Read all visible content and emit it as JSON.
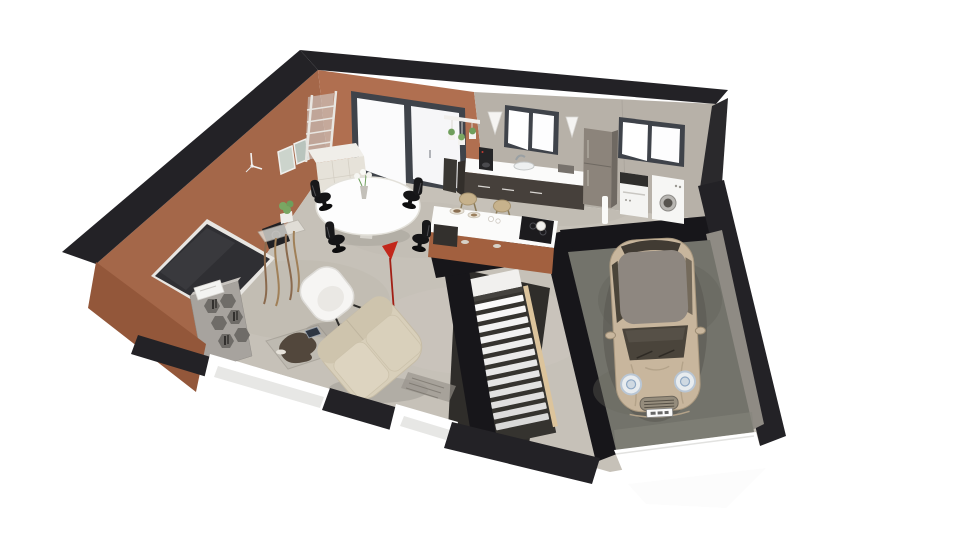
{
  "scene": {
    "type": "isometric-3d-floorplan-render",
    "description": "3D cutaway render of a single-storey house: open living/dining room with terracotta walls, kitchen with island, laundry corner, central staircase and attached garage with a parked compact car. Cut wall tops shown black, foundation shown white.",
    "rooms": [
      {
        "id": "living-room",
        "label": "Living room",
        "furniture": [
          "wall-mounted-tv",
          "speaker",
          "wall-clock",
          "picture-frames",
          "ladder-mirror",
          "honeycomb-shelf",
          "printer-box",
          "driftwood-console",
          "house-plant",
          "white-armchair",
          "cream-sofa",
          "glass-coffee-table",
          "tablet",
          "doormat"
        ]
      },
      {
        "id": "dining-area",
        "label": "Dining area",
        "furniture": [
          "white-sideboard",
          "oval-dining-table",
          "flower-vase",
          "black-designer-chair",
          "black-designer-chair",
          "black-designer-chair",
          "black-designer-chair",
          "red-floor-lamp"
        ]
      },
      {
        "id": "kitchen",
        "label": "Kitchen",
        "furniture": [
          "sliding-glass-door",
          "hanging-plant-shelf",
          "wall-sconce",
          "wall-sconce",
          "kitchen-window",
          "counter-with-sink",
          "coffee-machine",
          "fridge",
          "kitchen-island",
          "induction-hob",
          "bar-stool",
          "bar-stool",
          "dark-bin"
        ]
      },
      {
        "id": "laundry",
        "label": "Laundry corner",
        "furniture": [
          "laundry-window",
          "washing-machine",
          "tumble-dryer",
          "slim-white-lamp"
        ]
      },
      {
        "id": "stairwell",
        "label": "Staircase",
        "furniture": [
          "straight-staircase"
        ]
      },
      {
        "id": "garage",
        "label": "Garage",
        "furniture": [
          "parked-car"
        ]
      }
    ],
    "stairs": {
      "steps": 12
    },
    "car": {
      "type": "compact-hatchback",
      "body_color": "#c8b69d",
      "roof_color": "#8e8780"
    }
  },
  "colors": {
    "wall_terracotta": "#b06f50",
    "wall_terracotta_dark": "#a46749",
    "wall_terracotta_outer": "#93573a",
    "island_terracotta": "#a2603f",
    "wall_cut_dark": "#232226",
    "wall_gray": "#b7b1a8",
    "floor_main": "#c6c1b8",
    "floor_garage": "#73736b",
    "foundation_white": "#ffffff",
    "counter_dark": "#46403b",
    "countertop_white": "#fbfbfa",
    "appliance_white": "#f4f4f2",
    "fridge_taupe": "#8c847b",
    "sofa_cream": "#d8cfba",
    "armchair_white": "#f6f5f3",
    "shelf_gray": "#a7a39e",
    "car_body": "#c8b69d",
    "car_roof": "#8e8780",
    "accent_red": "#c2271b",
    "stair_wood": "#d2b88e",
    "window_frame": "#3f434a",
    "chair_black": "#151517"
  }
}
